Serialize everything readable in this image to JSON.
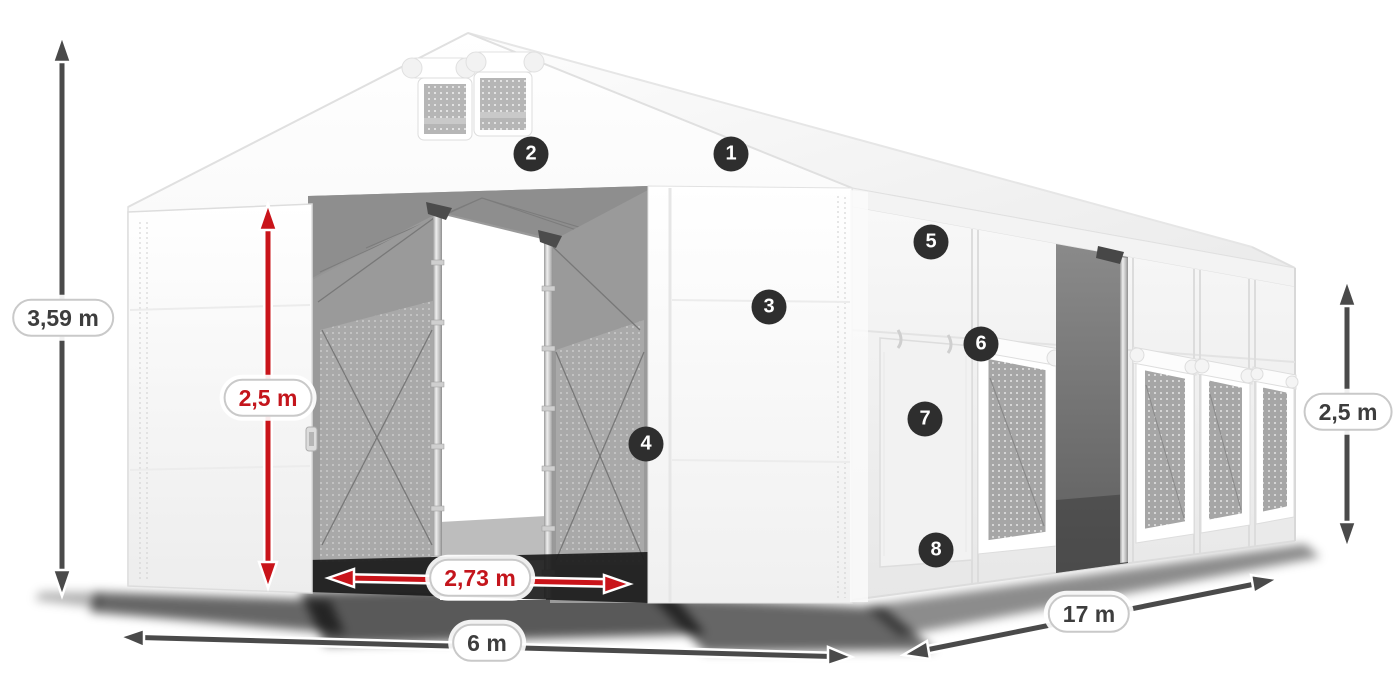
{
  "diagram": {
    "subject": "tent-dimensions-diagram"
  },
  "dimensions": {
    "total_height": "3,59 m",
    "entrance_height": "2,5 m",
    "entrance_width": "2,73 m",
    "width": "6 m",
    "length": "17 m",
    "side_height": "2,5 m"
  },
  "callouts": [
    {
      "number": "1"
    },
    {
      "number": "2"
    },
    {
      "number": "3"
    },
    {
      "number": "4"
    },
    {
      "number": "5"
    },
    {
      "number": "6"
    },
    {
      "number": "7"
    },
    {
      "number": "8"
    }
  ],
  "colors": {
    "dimension_red": "#c4151c",
    "dimension_dark": "#4a4a4a",
    "callout_background": "#2e2e2e",
    "tent_white": "#f5f5f5"
  }
}
